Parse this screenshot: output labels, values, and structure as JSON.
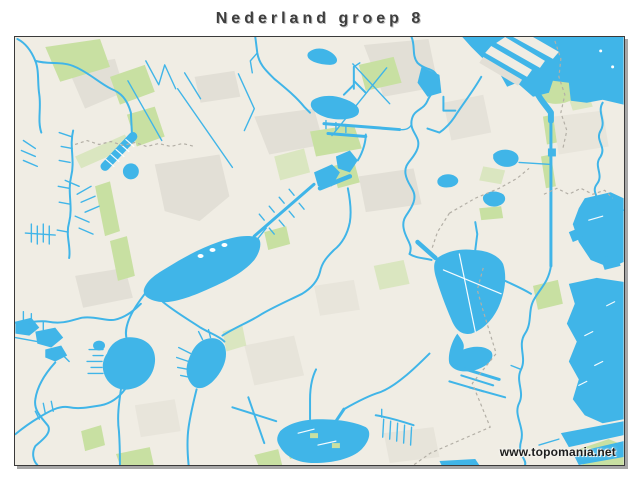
{
  "header": {
    "title": "Nederland groep 8"
  },
  "map": {
    "watermark": "www.topomania.net"
  },
  "colors": {
    "page-bg": "#ffffff",
    "land": "#f0ede4",
    "water": "#40b5e8",
    "green": "#c8e0a2",
    "urban": "#e2dfd6",
    "boundary": "#b3afa6",
    "frame": "#3a3a3a",
    "title-text": "#3e3e3e",
    "mark-text": "#1d1d1d"
  }
}
